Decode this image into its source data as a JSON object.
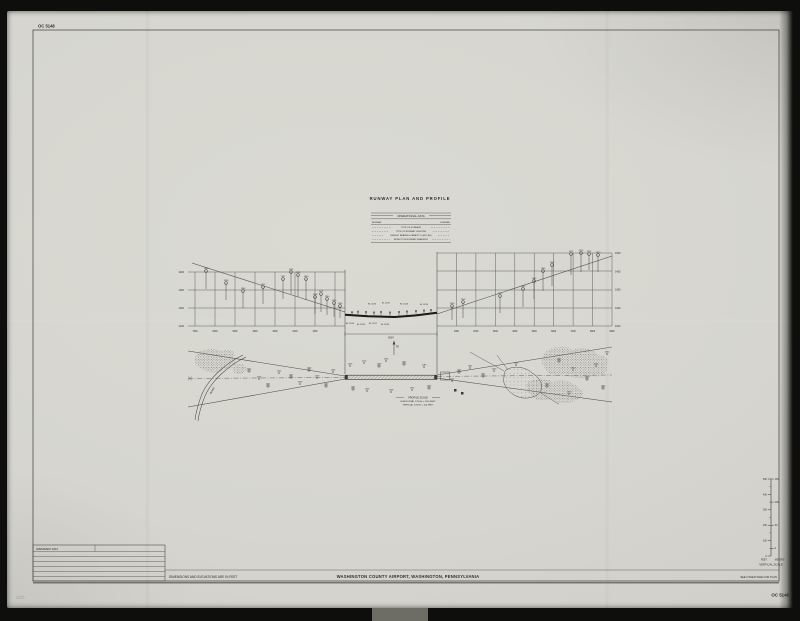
{
  "sheet": {
    "chart_no_top": "OC 5148",
    "chart_no_bottom": "OC 5148",
    "drawing_title": "RUNWAY PLAN AND PROFILE",
    "airport_title": "WASHINGTON COUNTY AIRPORT, WASHINGTON, PENNSYLVANIA",
    "units_note": "DIMENSIONS AND ELEVATIONS ARE IN FEET",
    "reverse_note": "SEE OTHER SIDE FOR PLAN",
    "pencil_note": "4115"
  },
  "operational_data": {
    "title": "OPERATIONAL DATA",
    "col_header_left": "RUNWAY",
    "col_header_right": "RUNWAY",
    "rows": [
      "TYPE OF SURFACE",
      "TYPE OF RUNWAY LIGHTING",
      "WEIGHT BEARING CAPACITY (000 LBS)",
      "EFFECTIVE RUNWAY GRADIENT"
    ]
  },
  "amendment_table": {
    "title": "AMENDMENT DATA"
  },
  "profile_scale": {
    "title": "PROFILE SCALE",
    "horizontal": "HORIZONTAL  1 INCH = 1000 FEET",
    "vertical": "VERTICAL  1 INCH = 100 FEET"
  },
  "vertical_scale": {
    "caption": "VERTICAL SCALE",
    "unit_left": "FEET",
    "unit_right": "METERS",
    "feet_labels": [
      "500",
      "400",
      "300",
      "200",
      "100",
      "0"
    ],
    "meter_labels": [
      "150",
      "100",
      "50",
      "0"
    ]
  },
  "center_profile": {
    "dim_label": "5004'",
    "north_label": "N",
    "el_above": [
      "EL 1186",
      "EL 1185",
      "EL 1184",
      "EL 1183"
    ],
    "el_below": [
      "EL 1184",
      "EL 1185",
      "EL 1187",
      "EL 1188"
    ]
  },
  "profiles": {
    "left": {
      "elev_labels": [
        "1400",
        "1300",
        "1200",
        "1100"
      ],
      "station_labels": [
        "7000",
        "6000",
        "5000",
        "4000",
        "3000",
        "2000",
        "1000"
      ],
      "trees": [
        {
          "x": 206,
          "y": 271,
          "b": 289,
          "l": "1368"
        },
        {
          "x": 226,
          "y": 283,
          "b": 300,
          "l": "1330"
        },
        {
          "x": 243,
          "y": 291,
          "b": 308,
          "l": "1300"
        },
        {
          "x": 263,
          "y": 287,
          "b": 304,
          "l": "1312"
        },
        {
          "x": 283,
          "y": 279,
          "b": 299,
          "l": "1327"
        },
        {
          "x": 291,
          "y": 272,
          "b": 294,
          "l": "1345"
        },
        {
          "x": 298,
          "y": 275,
          "b": 297,
          "l": "1338"
        },
        {
          "x": 306,
          "y": 279,
          "b": 300,
          "l": "1330"
        },
        {
          "x": 315,
          "y": 297,
          "b": 314,
          "l": "1268"
        },
        {
          "x": 321,
          "y": 294,
          "b": 312,
          "l": "1274"
        },
        {
          "x": 327,
          "y": 299,
          "b": 315,
          "l": "1260"
        },
        {
          "x": 334,
          "y": 303,
          "b": 317,
          "l": "1250"
        },
        {
          "x": 340,
          "y": 306,
          "b": 318,
          "l": "1243"
        }
      ]
    },
    "right": {
      "elev_labels": [
        "1500",
        "1400",
        "1300",
        "1200",
        "1100"
      ],
      "station_labels": [
        "1000",
        "2000",
        "3000",
        "4000",
        "5000",
        "6000",
        "7000",
        "8000",
        "9000"
      ],
      "trees": [
        {
          "x": 452,
          "y": 306,
          "b": 320,
          "l": "1240"
        },
        {
          "x": 463,
          "y": 302,
          "b": 318,
          "l": "1252"
        },
        {
          "x": 500,
          "y": 296,
          "b": 313,
          "l": "1272"
        },
        {
          "x": 523,
          "y": 289,
          "b": 307,
          "l": "1292"
        },
        {
          "x": 534,
          "y": 281,
          "b": 299,
          "l": "1312"
        },
        {
          "x": 543,
          "y": 271,
          "b": 291,
          "l": "1335"
        },
        {
          "x": 552,
          "y": 265,
          "b": 286,
          "l": "1346"
        },
        {
          "x": 571,
          "y": 254,
          "b": 275,
          "l": "1372"
        },
        {
          "x": 581,
          "y": 253,
          "b": 272,
          "l": "1375"
        },
        {
          "x": 589,
          "y": 254,
          "b": 270,
          "l": "1373"
        },
        {
          "x": 598,
          "y": 255,
          "b": 272,
          "l": "1370"
        }
      ]
    },
    "center_trees": [
      {
        "x": 352,
        "y": 312.2,
        "b": 315.8
      },
      {
        "x": 358,
        "y": 311.6,
        "b": 316
      },
      {
        "x": 366,
        "y": 312,
        "b": 316.3
      },
      {
        "x": 374,
        "y": 312.5,
        "b": 316.6
      },
      {
        "x": 381,
        "y": 312,
        "b": 316.8
      },
      {
        "x": 390,
        "y": 312.5,
        "b": 317
      },
      {
        "x": 399,
        "y": 312,
        "b": 316.6
      },
      {
        "x": 407,
        "y": 311.5,
        "b": 316.2
      },
      {
        "x": 416,
        "y": 311,
        "b": 315.6
      },
      {
        "x": 424,
        "y": 310.5,
        "b": 315
      },
      {
        "x": 431,
        "y": 310,
        "b": 314
      }
    ]
  },
  "plan": {
    "road_label": "ROAD",
    "obstructions": [
      {
        "x": 249,
        "y": 371,
        "l": "1245",
        "k": "c"
      },
      {
        "x": 259,
        "y": 379,
        "l": "1238",
        "k": "d"
      },
      {
        "x": 268,
        "y": 386,
        "l": "1231",
        "k": "c"
      },
      {
        "x": 279,
        "y": 373,
        "l": "1251",
        "k": "d"
      },
      {
        "x": 291,
        "y": 377,
        "l": "1247",
        "k": "c"
      },
      {
        "x": 300,
        "y": 384,
        "l": "1239",
        "k": "d"
      },
      {
        "x": 309,
        "y": 370,
        "l": "1256",
        "k": "c"
      },
      {
        "x": 317,
        "y": 378,
        "l": "1249",
        "k": "d"
      },
      {
        "x": 326,
        "y": 386,
        "l": "1242",
        "k": "c"
      },
      {
        "x": 333,
        "y": 372,
        "l": "1246",
        "k": "d"
      },
      {
        "x": 350,
        "y": 366,
        "l": "1205",
        "k": "d"
      },
      {
        "x": 353,
        "y": 389,
        "l": "1207",
        "k": "c"
      },
      {
        "x": 364,
        "y": 363,
        "l": "1210",
        "k": "d"
      },
      {
        "x": 367,
        "y": 391,
        "l": "1203",
        "k": "d"
      },
      {
        "x": 379,
        "y": 366,
        "l": "1199",
        "k": "c"
      },
      {
        "x": 386,
        "y": 361,
        "l": "1196",
        "k": "d"
      },
      {
        "x": 391,
        "y": 392,
        "l": "1198",
        "k": "d"
      },
      {
        "x": 404,
        "y": 364,
        "l": "1192",
        "k": "c"
      },
      {
        "x": 412,
        "y": 390,
        "l": "1195",
        "k": "d"
      },
      {
        "x": 424,
        "y": 367,
        "l": "1189",
        "k": "d"
      },
      {
        "x": 429,
        "y": 388,
        "l": "1190",
        "k": "c"
      },
      {
        "x": 452,
        "y": 381,
        "l": "1216",
        "k": "d"
      },
      {
        "x": 459,
        "y": 372,
        "l": "1223",
        "k": "c"
      },
      {
        "x": 470,
        "y": 368,
        "l": "1231",
        "k": "d"
      },
      {
        "x": 483,
        "y": 376,
        "l": "1237",
        "k": "c"
      },
      {
        "x": 494,
        "y": 371,
        "l": "1243",
        "k": "d"
      },
      {
        "x": 516,
        "y": 365,
        "l": "1249",
        "k": "d"
      },
      {
        "x": 559,
        "y": 361,
        "l": "1312",
        "k": "c"
      },
      {
        "x": 573,
        "y": 370,
        "l": "1324",
        "k": "d"
      },
      {
        "x": 587,
        "y": 379,
        "l": "1336",
        "k": "c"
      },
      {
        "x": 596,
        "y": 366,
        "l": "1341",
        "k": "d"
      },
      {
        "x": 603,
        "y": 388,
        "l": "1346",
        "k": "c"
      },
      {
        "x": 569,
        "y": 394,
        "l": "1330",
        "k": "d"
      },
      {
        "x": 547,
        "y": 386,
        "l": "1320",
        "k": "c"
      },
      {
        "x": 607,
        "y": 354,
        "l": "1352",
        "k": "d"
      }
    ]
  }
}
